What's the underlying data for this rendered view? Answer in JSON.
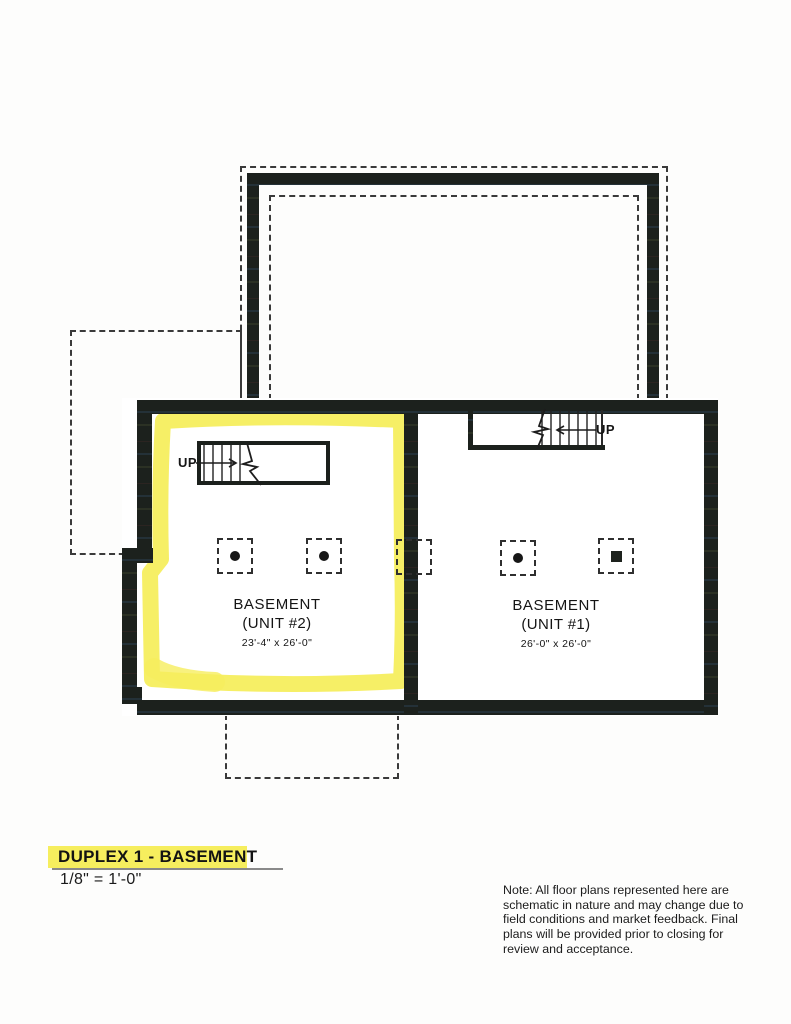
{
  "document": {
    "title": "DUPLEX 1 - BASEMENT",
    "scale": "1/8\" = 1'-0\"",
    "note": "Note: All floor plans represented here are schematic in nature and may change due to field conditions and market feedback. Final plans will be provided prior to closing for review and acceptance."
  },
  "plan": {
    "unit2": {
      "room": "BASEMENT",
      "unit": "(UNIT #2)",
      "dimensions": "23'-4\" x 26'-0\"",
      "stair_label": "UP"
    },
    "unit1": {
      "room": "BASEMENT",
      "unit": "(UNIT #1)",
      "dimensions": "26'-0\" x 26'-0\"",
      "stair_label": "UP"
    }
  },
  "colors": {
    "wall": "#1c211d",
    "highlight": "#f6ee5e",
    "dash": "#3a3a3a",
    "underline": "#8a8a8a"
  }
}
